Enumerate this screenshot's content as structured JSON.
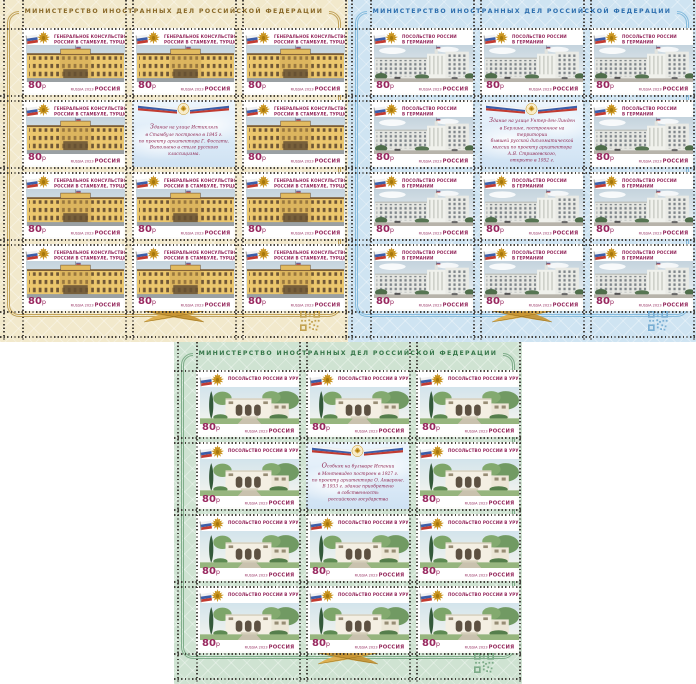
{
  "sheets": [
    {
      "id": "istanbul",
      "header": "МИНИСТЕРСТВО ИНОСТРАННЫХ ДЕЛ РОССИЙСКОЙ ФЕДЕРАЦИИ",
      "theme": {
        "bg": "#f2e9cc",
        "line": "#c2a35a",
        "header_text": "#8a6a2a",
        "qr": "#c3a251"
      },
      "stamp": {
        "title_lines": [
          "ГЕНЕРАЛЬНОЕ КОНСУЛЬСТВО",
          "РОССИИ В СТАМБУЛЕ, ТУРЦИЯ"
        ],
        "denomination": "80",
        "currency": "р",
        "issue": "RUSSIA 2023",
        "country": "РОССИЯ"
      },
      "label": {
        "lines": [
          "Здание на улице Истикляль",
          "в Стамбуле построено в 1845 г.",
          "по проекту архитектора Г. Фоссати.",
          "Выполнено в стиле русского классицизма."
        ]
      },
      "grid": {
        "rows": 4,
        "cols": 3,
        "label_row": 2,
        "label_col": 2,
        "stamp_count": 11
      }
    },
    {
      "id": "germany",
      "header": "МИНИСТЕРСТВО ИНОСТРАННЫХ ДЕЛ РОССИЙСКОЙ ФЕДЕРАЦИИ",
      "theme": {
        "bg": "#cfe4f2",
        "line": "#85bbdd",
        "header_text": "#2e6fae",
        "qr": "#79aed3"
      },
      "stamp": {
        "title_lines": [
          "ПОСОЛЬСТВО РОССИИ",
          "В ГЕРМАНИИ"
        ],
        "denomination": "80",
        "currency": "р",
        "issue": "RUSSIA 2023",
        "country": "РОССИЯ"
      },
      "label": {
        "lines": [
          "Здание на улице Унтер-ден-Линден",
          "в Берлине, построенное на территории",
          "бывшей русской дипломатической",
          "миссии по проекту архитектора",
          "А.Я. Стрижевского,",
          "открыто в 1952 г."
        ]
      },
      "grid": {
        "rows": 4,
        "cols": 3,
        "label_row": 2,
        "label_col": 2,
        "stamp_count": 11
      }
    },
    {
      "id": "uruguay",
      "header": "МИНИСТЕРСТВО ИНОСТРАННЫХ ДЕЛ РОССИЙСКОЙ ФЕДЕРАЦИИ",
      "theme": {
        "bg": "#cfe3d2",
        "line": "#7fae8a",
        "header_text": "#37774a",
        "qr": "#7cab88"
      },
      "stamp": {
        "title_lines": [
          "ПОСОЛЬСТВО РОССИИ В УРУГВАЕ"
        ],
        "denomination": "80",
        "currency": "р",
        "issue": "RUSSIA 2023",
        "country": "РОССИЯ"
      },
      "label": {
        "lines": [
          "Особняк на бульваре Испании",
          "в Монтевидео построен в 1927 г.",
          "по проекту архитектора О. Аквароне.",
          "В 1933 г. здание приобретено",
          "в собственность",
          "российского государства"
        ]
      },
      "grid": {
        "rows": 4,
        "cols": 3,
        "label_row": 2,
        "label_col": 2,
        "stamp_count": 11
      }
    }
  ]
}
